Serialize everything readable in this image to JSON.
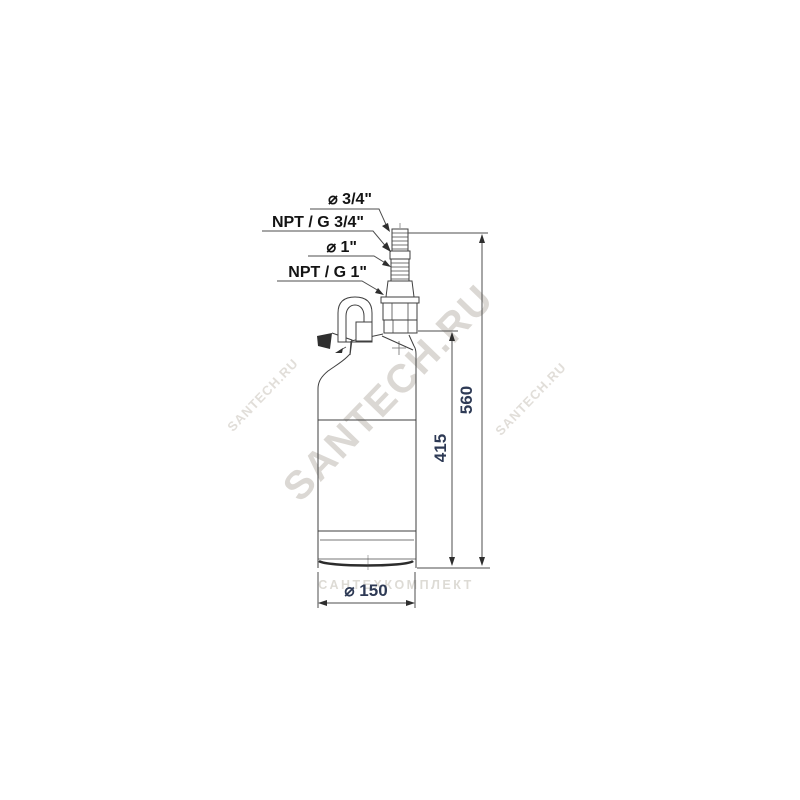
{
  "drawing": {
    "connection_labels": [
      "⌀ 3/4\"",
      "NPT / G 3/4\"",
      "⌀ 1\"",
      "NPT / G 1\""
    ],
    "dimensions": {
      "overall_height": "560",
      "body_height": "415",
      "base_diameter": "⌀ 150"
    },
    "line_color": "#3f3f3f",
    "dimension_text_color": "#2e3a55",
    "label_text_color": "#141414"
  },
  "watermarks": {
    "center": "SANTECH.RU",
    "left": "SANTECH.RU",
    "right": "SANTECH.RU",
    "bottom": "САНТЕХКОМПЛЕКТ",
    "color": "#b9b3aa"
  }
}
